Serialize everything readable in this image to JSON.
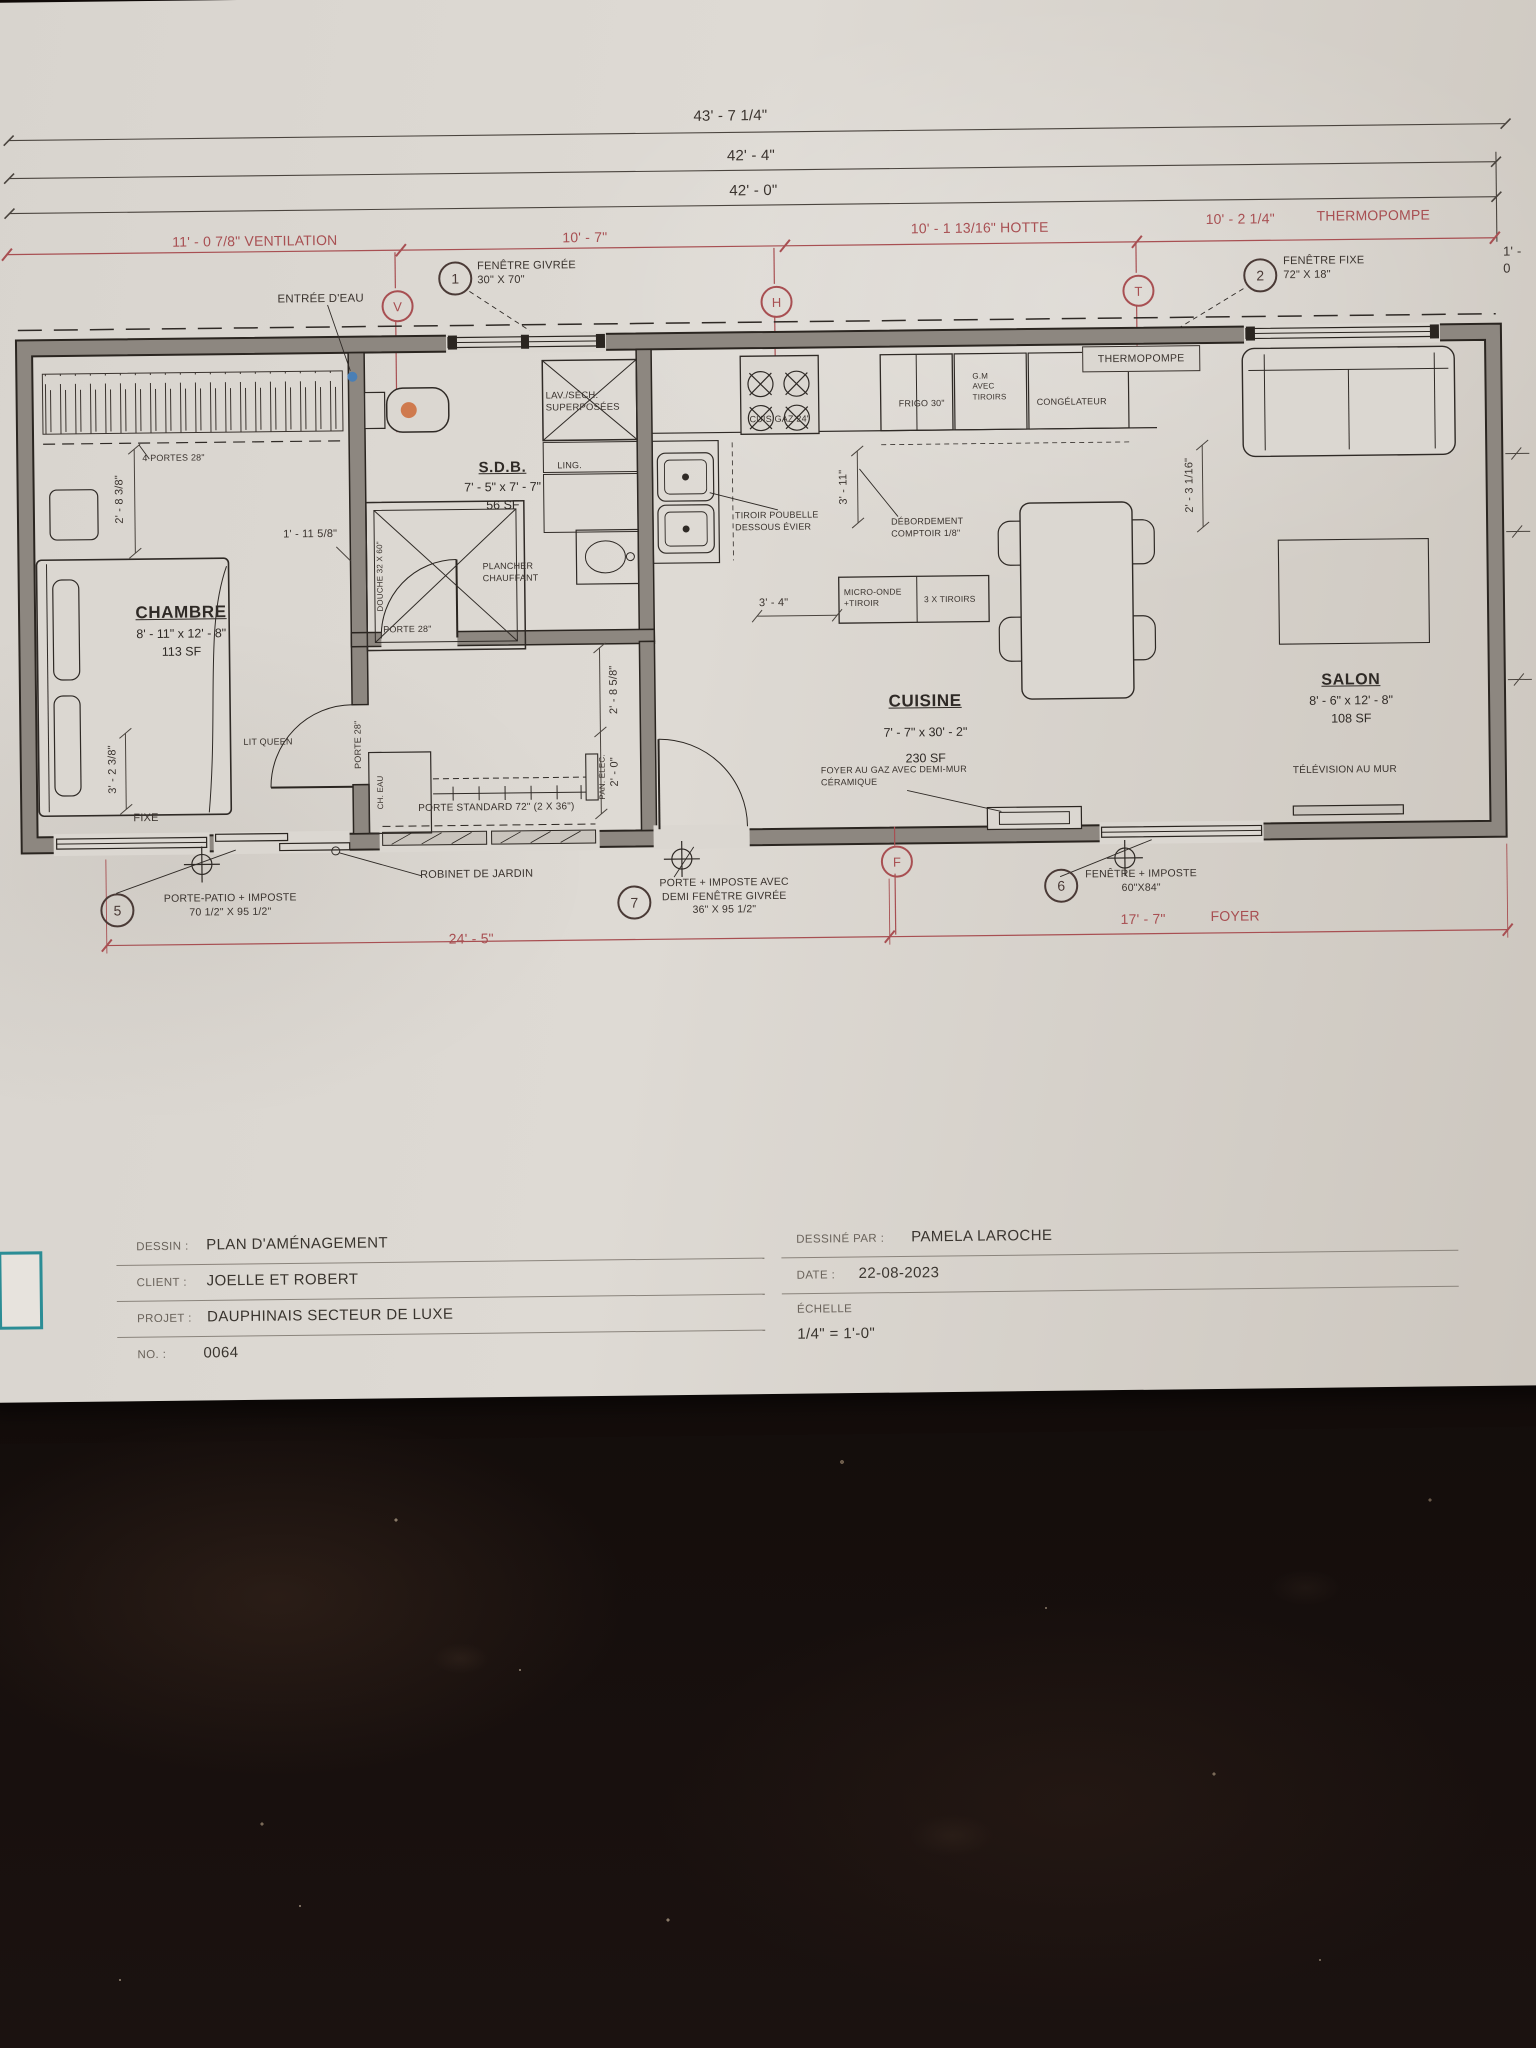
{
  "sheet": {
    "top_dims": {
      "d1": "43' - 7 1/4\"",
      "d2": "42' - 4\"",
      "d3": "42' - 0\""
    },
    "red_dims": {
      "ventilation": "11' - 0 7/8\" VENTILATION",
      "d10_7": "10' - 7\"",
      "hotte": "10' - 1 13/16\" HOTTE",
      "thermo_dim": "10' - 2 1/4\"",
      "thermo_word": "THERMOPOMPE",
      "right_edge": "1' - 0",
      "bottom_left": "24' - 5\"",
      "bottom_right_dim": "17' - 7\"",
      "bottom_right_word": "FOYER"
    },
    "markers": {
      "v": "V",
      "h": "H",
      "t": "T",
      "f": "F"
    },
    "callouts": {
      "c1": {
        "num": "1",
        "text": "FENÊTRE GIVRÉE\n30\" X 70\""
      },
      "c2": {
        "num": "2",
        "text": "FENÊTRE FIXE\n72\" X 18\""
      },
      "c5": {
        "num": "5",
        "text": "PORTE-PATIO + IMPOSTE\n70 1/2\" X 95 1/2\""
      },
      "c6": {
        "num": "6",
        "text": "FENÊTRE + IMPOSTE\n60\"X84\""
      },
      "c7": {
        "num": "7",
        "text": "PORTE + IMPOSTE AVEC\nDEMI FENÊTRE GIVRÉE\n36\" X 95 1/2\""
      }
    },
    "rooms": {
      "chambre": {
        "name": "CHAMBRE",
        "dims": "8' - 11\" x  12' - 8\"",
        "area": "113 SF"
      },
      "sdb": {
        "name": "S.D.B.",
        "dims": "7' - 5\" x  7' - 7\"",
        "area": "56 SF"
      },
      "cuisine": {
        "name": "CUISINE",
        "dims": "7' - 7\" x  30' - 2\"",
        "area": "230 SF"
      },
      "salon": {
        "name": "SALON",
        "dims": "8' - 6\" x  12' - 8\"",
        "area": "108 SF"
      }
    },
    "labels": {
      "entree_eau": "ENTRÉE D'EAU",
      "portes4": "4 PORTES 28\"",
      "lit_queen": "LIT QUEEN",
      "fixe": "FIXE",
      "porte28_hall": "PORTE 28\"",
      "porte28_sdb": "PORTE 28\"",
      "ch_eau": "CH. EAU",
      "pan_elec": "PAN. ÉLEC.",
      "porte_standard": "PORTE STANDARD 72\" (2 X 36\")",
      "douche": "DOUCHE 32 X 60\"",
      "plancher": "PLANCHER\nCHAUFFANT",
      "lav_sech": "LAV./SÉCH.\nSUPERPOSÉES",
      "ling": "LING.",
      "cuis_gaz": "CUIS GAZ 24\"",
      "frigo": "FRIGO 30\"",
      "gm": "G.M\nAVEC\nTIROIRS",
      "congelateur": "CONGÉLATEUR",
      "thermopompe": "THERMOPOMPE",
      "tiroir_poubelle": "TIROIR POUBELLE\nDESSOUS ÉVIER",
      "debordement": "DÉBORDEMENT\nCOMPTOIR 1/8\"",
      "micro_onde": "MICRO-ONDE\n+TIROIR",
      "tiroirs3": "3 X TIROIRS",
      "foyer_gaz": "FOYER AU GAZ AVEC DEMI-MUR\nCÉRAMIQUE",
      "television": "TÉLÉVISION AU MUR",
      "robinet": "ROBINET DE JARDIN"
    },
    "interior_dims": {
      "d283": "2' - 8 3/8\"",
      "d1115": "1' - 11 5/8\"",
      "d323": "3' - 2 3/8\"",
      "d2858": "2' - 8 5/8\"",
      "d20": "2' - 0\"",
      "d311": "3' - 11\"",
      "d34": "3' - 4\"",
      "d2316": "2' - 3 1/16\""
    }
  },
  "title_block": {
    "dessin_label": "DESSIN :",
    "dessin": "PLAN D'AMÉNAGEMENT",
    "client_label": "CLIENT :",
    "client": "JOELLE ET ROBERT",
    "projet_label": "PROJET :",
    "projet": "DAUPHINAIS SECTEUR DE LUXE",
    "no_label": "NO. :",
    "no": "0064",
    "par_label": "DESSINÉ PAR :",
    "par": "PAMELA LAROCHE",
    "date_label": "DATE :",
    "date": "22-08-2023",
    "echelle_label": "ÉCHELLE",
    "echelle": "1/4\" = 1'-0\""
  }
}
